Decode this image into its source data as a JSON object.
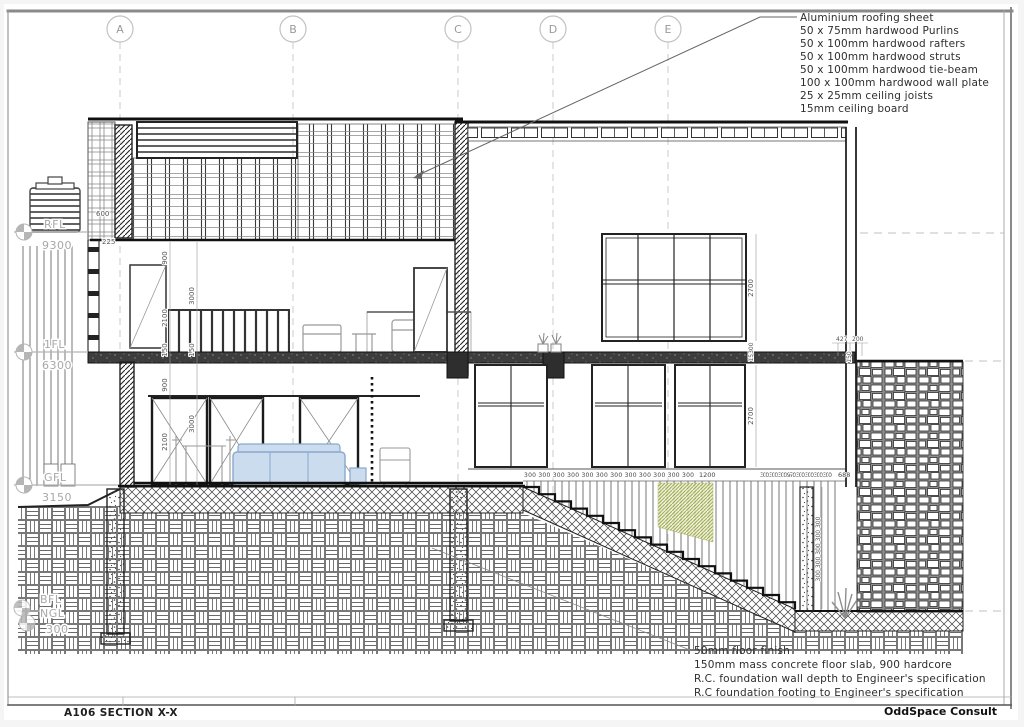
{
  "drawing": {
    "sheet_title": "A106 SECTION X-X",
    "consultant": "OddSpace Consult"
  },
  "grids": {
    "labels": [
      "A",
      "B",
      "C",
      "D",
      "E"
    ]
  },
  "roof_callout": {
    "lines": [
      "Aluminium roofing sheet",
      "50 x 75mm hardwood Purlins",
      "50 x 100mm hardwood rafters",
      "50 x 100mm hardwood struts",
      "50 x 100mm hardwood tie-beam",
      "100 x 100mm hardwood wall plate",
      "25 x 25mm ceiling joists",
      "15mm ceiling board"
    ]
  },
  "foundation_callout": {
    "lines": [
      "50mm floor finish",
      "150mm mass concrete floor slab, 900 hardcore",
      "R.C. foundation wall depth to Engineer's specification",
      "R.C foundation footing to Engineer's specification"
    ]
  },
  "levels": [
    {
      "label": "RFL",
      "value": "9300"
    },
    {
      "label": "1FL",
      "value": "6300"
    },
    {
      "label": "GFL",
      "value": "3150"
    },
    {
      "label": "BFL",
      "value": ""
    },
    {
      "label": "NGL",
      "value": "300"
    }
  ],
  "dimensions": {
    "d600": "600",
    "d225": "225",
    "d900": "900",
    "d3000": "3000",
    "d2100": "2100",
    "d150": "150",
    "d2700": "2700",
    "d15300": "15300",
    "d427": "427",
    "d200": "200",
    "d1200": "1200",
    "d688": "688",
    "treads_left": "300 300 300 300 300 300 300 300 300 300 300 300",
    "treads_right": "300 300 300 970 300 300 300 300",
    "risers": "300 300 300 300 300"
  },
  "colors": {
    "line_dark": "#1a1a1a",
    "line_gray": "#888888",
    "level_gray": "#aaaaaa",
    "sofa_blue": "#ccdcef",
    "plant_green": "#98a23f"
  }
}
